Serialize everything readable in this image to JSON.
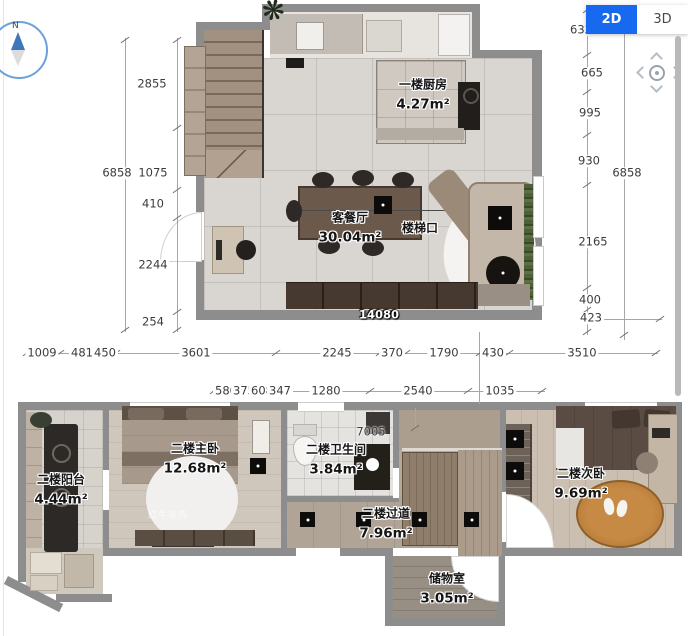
{
  "view_toggle": {
    "mode_2d": "2D",
    "mode_3d": "3D"
  },
  "compass": {
    "north_label": "N"
  },
  "floor1": {
    "rooms": [
      {
        "name": "一楼厨房",
        "area": "4.27m²"
      },
      {
        "name": "客餐厅",
        "area": "30.04m²"
      },
      {
        "name": "楼梯口",
        "area": ""
      }
    ],
    "width_label": "14080"
  },
  "floor2": {
    "rooms": [
      {
        "name": "二楼阳台",
        "area": "4.44m²"
      },
      {
        "name": "二楼主卧",
        "area": "12.68m²"
      },
      {
        "name": "二楼卫生间",
        "area": "3.84m²"
      },
      {
        "name": "二楼过道",
        "area": "7.96m²"
      },
      {
        "name": "二楼次卧",
        "area": "9.69m²"
      },
      {
        "name": "储物室",
        "area": "3.05m²"
      }
    ],
    "width_label": "7005"
  },
  "dimensions": {
    "left_inner": [
      "2855",
      "1075",
      "410",
      "2244",
      "254"
    ],
    "left_outer": "6858",
    "right_inner": [
      "633",
      "665",
      "995",
      "930",
      "2165",
      "400",
      "423"
    ],
    "right_outer": "6858",
    "bottom_row1": [
      "1009",
      "481",
      "450",
      "3601",
      "2245",
      "370",
      "1790",
      "430",
      "3510"
    ],
    "bottom_row2": [
      "580",
      "375",
      "608",
      "347",
      "1280",
      "2540",
      "1035"
    ]
  },
  "watermark": "红牛装饰"
}
